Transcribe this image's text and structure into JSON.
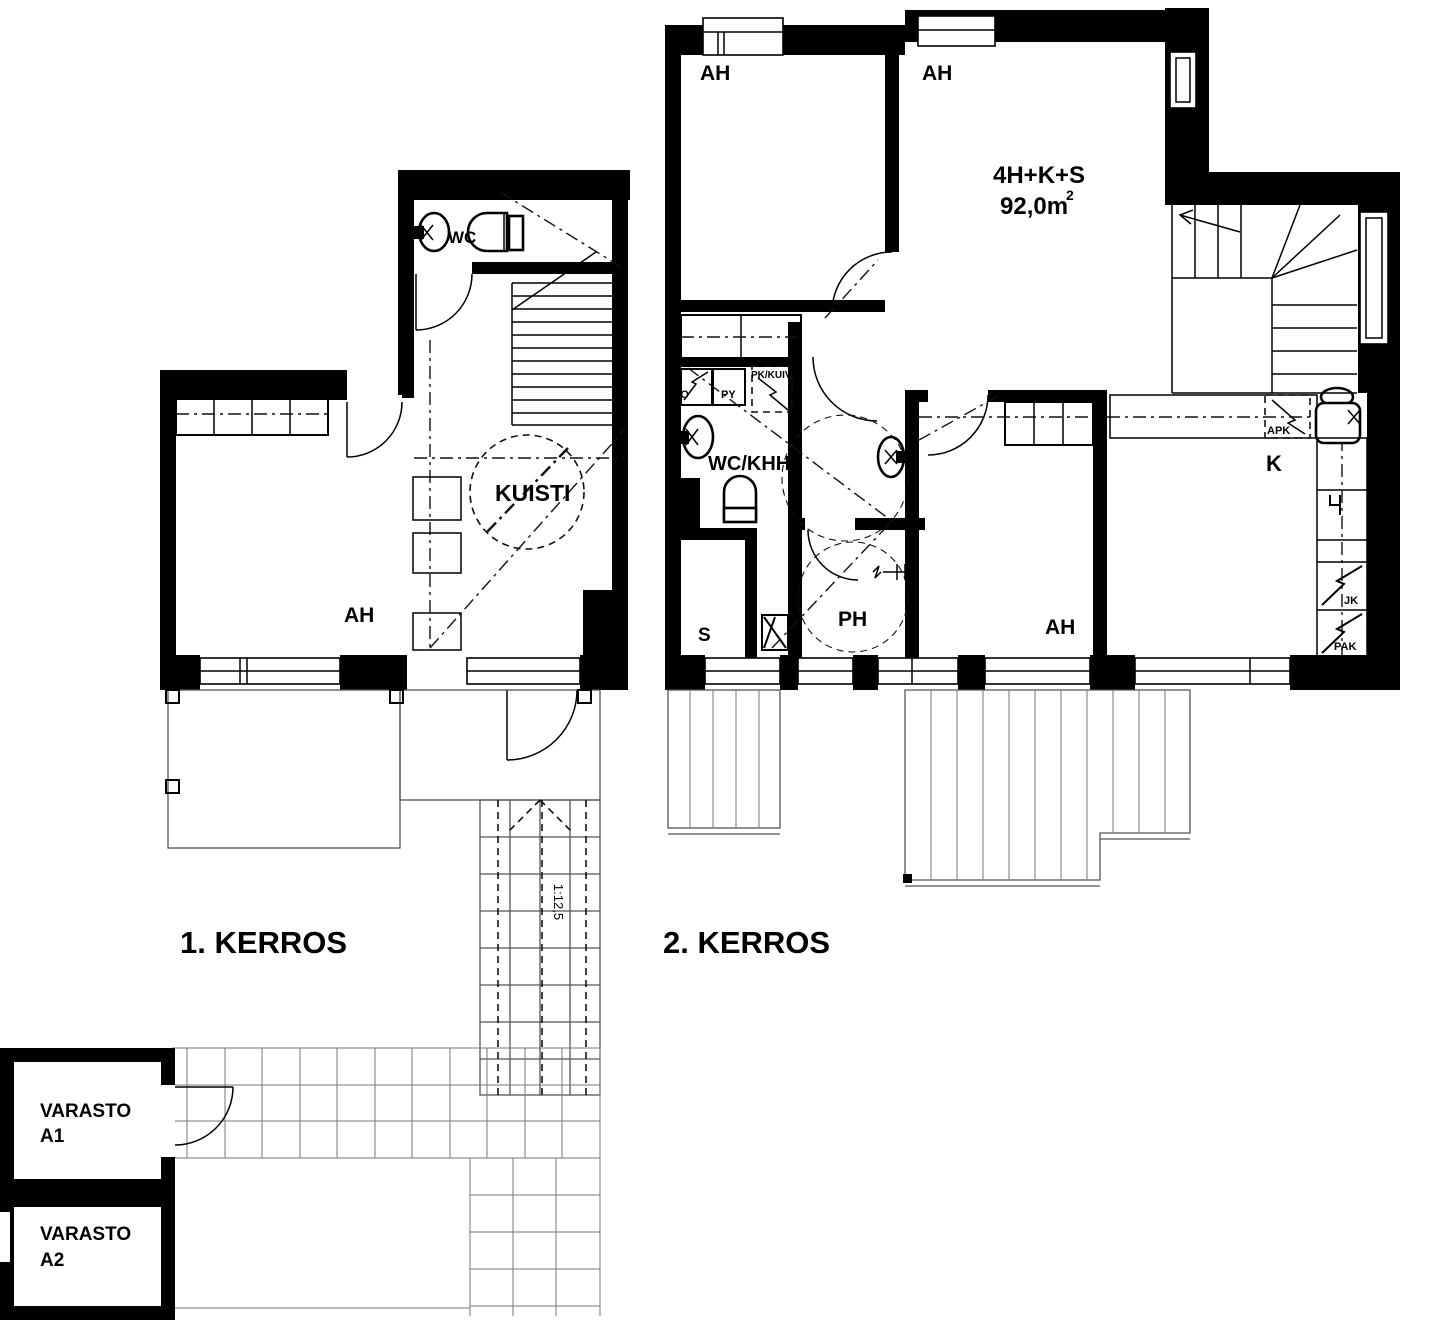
{
  "floor1": {
    "title": "1. KERROS",
    "labels": {
      "wc": "WC",
      "kuisti": "KUISTI",
      "ah": "AH"
    },
    "ramp_slope": "1:12,5"
  },
  "floor2": {
    "title": "2. KERROS",
    "apartment_type": "4H+K+S",
    "apartment_area": "92,0m",
    "apartment_area_sup": "2",
    "labels": {
      "ah_top_left": "AH",
      "ah_top_right": "AH",
      "ah_bottom": "AH",
      "wc_khh": "WC/KHH",
      "sauna": "S",
      "ph": "PH",
      "kitchen": "K",
      "lto": "LTO",
      "py": "PY",
      "pk_kuiv": "PK/KUIV",
      "apk": "APK",
      "jk": "JK",
      "pak": "PAK"
    }
  },
  "storage": {
    "a1_line1": "VARASTO",
    "a1_line2": "A1",
    "a2_line1": "VARASTO",
    "a2_line2": "A2"
  },
  "colors": {
    "wall": "#000000",
    "background": "#ffffff"
  }
}
